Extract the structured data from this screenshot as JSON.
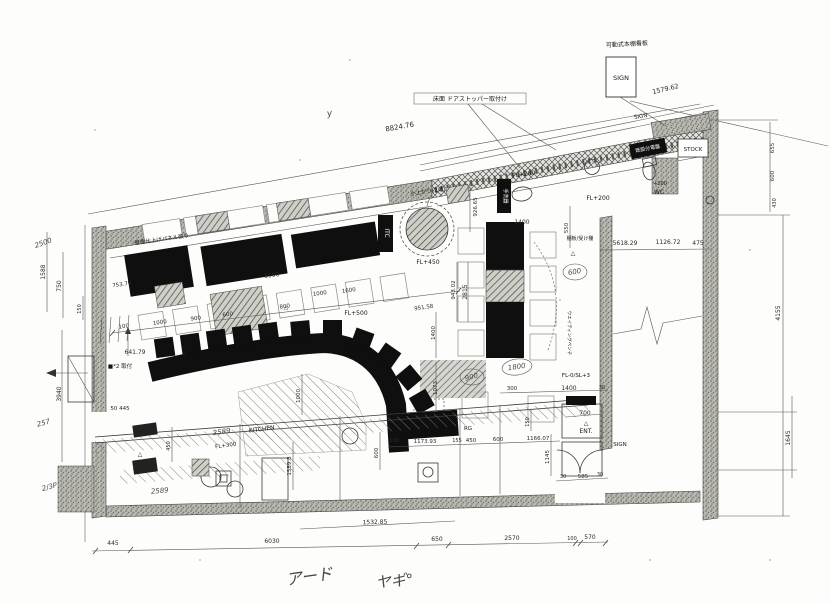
{
  "document": {
    "kind": "scanned architectural floor plan",
    "rooms": [
      "KITCHEN",
      "STOCK",
      "WC",
      "ENT."
    ],
    "floor_levels": [
      "FL+200",
      "FL+200",
      "FL+300",
      "FL+450",
      "FL+500",
      "FL-0/SL+3",
      "+200"
    ],
    "signs": [
      "SIGN",
      "SIGN",
      "SIGN",
      "SIGN"
    ],
    "colors": {
      "paper": "#fdfdfb",
      "ink": "#1f1f1f",
      "wall_gray": "#b9b9b2",
      "fill_black": "#0f0f0f"
    }
  },
  "annotations": [
    {
      "t": "可動式本棚看板",
      "x": 627,
      "y": 46,
      "r": -3,
      "s": 6,
      "c": "l"
    },
    {
      "t": "SIGN",
      "x": 621,
      "y": 80,
      "r": 0,
      "s": 6.5,
      "c": "l"
    },
    {
      "t": "1579.62",
      "x": 666,
      "y": 91,
      "r": -13,
      "s": 6.5,
      "c": "d"
    },
    {
      "t": "SIGN",
      "x": 641,
      "y": 118,
      "r": -10,
      "s": 5.5,
      "c": "l"
    },
    {
      "t": "8824.76",
      "x": 400,
      "y": 129,
      "r": -10,
      "s": 7,
      "c": "d"
    },
    {
      "t": "床面 ドアストッパー取付け",
      "x": 470,
      "y": 101,
      "r": 0,
      "s": 6,
      "c": "l"
    },
    {
      "t": "y",
      "x": 330,
      "y": 116,
      "r": -10,
      "s": 9,
      "c": "h"
    },
    {
      "t": "STOCK",
      "x": 693,
      "y": 151,
      "r": 0,
      "s": 5.5,
      "c": "l"
    },
    {
      "t": "既設分電盤",
      "x": 648,
      "y": 150,
      "r": -11,
      "s": 5,
      "c": "w"
    },
    {
      "t": "FL+200",
      "x": 524,
      "y": 176,
      "r": -8,
      "s": 6,
      "c": "l"
    },
    {
      "t": "FL+200",
      "x": 598,
      "y": 200,
      "r": 0,
      "s": 6,
      "c": "l"
    },
    {
      "t": "+200",
      "x": 660,
      "y": 185,
      "r": 0,
      "s": 5,
      "c": "l"
    },
    {
      "t": "WC",
      "x": 659,
      "y": 194,
      "r": 0,
      "s": 6,
      "c": "l"
    },
    {
      "t": "手洗器",
      "x": 504,
      "y": 196,
      "r": 90,
      "s": 5,
      "c": "w"
    },
    {
      "t": "小上がり(2卓)",
      "x": 428,
      "y": 193,
      "r": -8,
      "s": 5.5,
      "c": "l"
    },
    {
      "t": "ITC",
      "x": 385,
      "y": 233,
      "r": 90,
      "s": 6,
      "c": "w"
    },
    {
      "t": "FL+450",
      "x": 428,
      "y": 264,
      "r": 0,
      "s": 6,
      "c": "l"
    },
    {
      "t": "926.65",
      "x": 477,
      "y": 207,
      "r": -90,
      "s": 5.5,
      "c": "d"
    },
    {
      "t": "943.02",
      "x": 455,
      "y": 290,
      "r": -90,
      "s": 5.5,
      "c": "d"
    },
    {
      "t": "2815",
      "x": 467,
      "y": 292,
      "r": -90,
      "s": 6,
      "c": "d"
    },
    {
      "t": "5618.29",
      "x": 625,
      "y": 245,
      "r": 0,
      "s": 6,
      "c": "d"
    },
    {
      "t": "1126.72",
      "x": 668,
      "y": 244,
      "r": 0,
      "s": 6,
      "c": "d"
    },
    {
      "t": "475",
      "x": 698,
      "y": 245,
      "r": 0,
      "s": 6,
      "c": "d"
    },
    {
      "t": "550",
      "x": 568,
      "y": 228,
      "r": -90,
      "s": 5.5,
      "c": "d"
    },
    {
      "t": "1400",
      "x": 522,
      "y": 224,
      "r": 0,
      "s": 6,
      "c": "d"
    },
    {
      "t": "棚板/受け棚",
      "x": 580,
      "y": 240,
      "r": 0,
      "s": 5,
      "c": "l"
    },
    {
      "t": "△",
      "x": 573,
      "y": 255,
      "r": 0,
      "s": 6,
      "c": "l"
    },
    {
      "t": "壁面仕上げパネル張り",
      "x": 162,
      "y": 241,
      "r": -8,
      "s": 5.5,
      "c": "l"
    },
    {
      "t": "753.79",
      "x": 122,
      "y": 286,
      "r": -8,
      "s": 5.5,
      "c": "d"
    },
    {
      "t": "5500",
      "x": 272,
      "y": 277,
      "r": -8,
      "s": 6,
      "c": "d"
    },
    {
      "t": "100",
      "x": 124,
      "y": 328,
      "r": -8,
      "s": 5.5,
      "c": "d"
    },
    {
      "t": "1000",
      "x": 160,
      "y": 324,
      "r": -8,
      "s": 5.5,
      "c": "d"
    },
    {
      "t": "900",
      "x": 196,
      "y": 320,
      "r": -8,
      "s": 5.5,
      "c": "d"
    },
    {
      "t": "600",
      "x": 228,
      "y": 316,
      "r": -8,
      "s": 5.5,
      "c": "d"
    },
    {
      "t": "800",
      "x": 285,
      "y": 308,
      "r": -8,
      "s": 5.5,
      "c": "d"
    },
    {
      "t": "1000",
      "x": 320,
      "y": 295,
      "r": -8,
      "s": 5.5,
      "c": "d"
    },
    {
      "t": "1600",
      "x": 349,
      "y": 292,
      "r": -8,
      "s": 5.5,
      "c": "d"
    },
    {
      "t": "△",
      "x": 286,
      "y": 309,
      "r": 0,
      "s": 5.5,
      "c": "l"
    },
    {
      "t": "FL+500",
      "x": 356,
      "y": 315,
      "r": 0,
      "s": 6,
      "c": "l"
    },
    {
      "t": "951.58",
      "x": 424,
      "y": 309,
      "r": -8,
      "s": 5.5,
      "c": "d"
    },
    {
      "t": "1400",
      "x": 435,
      "y": 333,
      "r": -90,
      "s": 5.5,
      "c": "d"
    },
    {
      "t": "1073",
      "x": 437,
      "y": 388,
      "r": -90,
      "s": 5.5,
      "c": "d"
    },
    {
      "t": "1000",
      "x": 300,
      "y": 396,
      "r": -90,
      "s": 5.5,
      "c": "d"
    },
    {
      "t": "641.79",
      "x": 135,
      "y": 354,
      "r": 0,
      "s": 6,
      "c": "d"
    },
    {
      "t": "■*2 取付",
      "x": 120,
      "y": 368,
      "r": 0,
      "s": 5.5,
      "c": "l"
    },
    {
      "t": "3940",
      "x": 61,
      "y": 394,
      "r": -90,
      "s": 6,
      "c": "d"
    },
    {
      "t": "1588",
      "x": 45,
      "y": 272,
      "r": -90,
      "s": 6,
      "c": "d"
    },
    {
      "t": "750",
      "x": 61,
      "y": 286,
      "r": -90,
      "s": 6,
      "c": "d"
    },
    {
      "t": "150",
      "x": 81,
      "y": 309,
      "r": -90,
      "s": 5,
      "c": "d"
    },
    {
      "t": "2500",
      "x": 44,
      "y": 245,
      "r": -20,
      "s": 7,
      "c": "h"
    },
    {
      "t": "257",
      "x": 44,
      "y": 425,
      "r": -15,
      "s": 7,
      "c": "h"
    },
    {
      "t": "2/3P",
      "x": 50,
      "y": 489,
      "r": -15,
      "s": 7,
      "c": "h"
    },
    {
      "t": "50 445",
      "x": 120,
      "y": 410,
      "r": 0,
      "s": 5.5,
      "c": "d"
    },
    {
      "t": "△",
      "x": 140,
      "y": 456,
      "r": 0,
      "s": 6,
      "c": "l"
    },
    {
      "t": "KITCHEN",
      "x": 262,
      "y": 431,
      "r": -8,
      "s": 6,
      "c": "l"
    },
    {
      "t": "FL+300",
      "x": 226,
      "y": 447,
      "r": -8,
      "s": 5.5,
      "c": "l"
    },
    {
      "t": "2589",
      "x": 222,
      "y": 434,
      "r": -8,
      "s": 7,
      "c": "h"
    },
    {
      "t": "2589",
      "x": 160,
      "y": 493,
      "r": -5,
      "s": 7,
      "c": "h"
    },
    {
      "t": "450",
      "x": 170,
      "y": 446,
      "r": -90,
      "s": 5,
      "c": "d"
    },
    {
      "t": "1559.8",
      "x": 291,
      "y": 466,
      "r": -90,
      "s": 5.5,
      "c": "d"
    },
    {
      "t": "600",
      "x": 378,
      "y": 453,
      "r": -90,
      "s": 5.5,
      "c": "d"
    },
    {
      "t": "100",
      "x": 394,
      "y": 442,
      "r": 0,
      "s": 5,
      "c": "d"
    },
    {
      "t": "1173.93",
      "x": 425,
      "y": 443,
      "r": 0,
      "s": 5.5,
      "c": "d"
    },
    {
      "t": "155",
      "x": 457,
      "y": 442,
      "r": 0,
      "s": 5,
      "c": "d"
    },
    {
      "t": "450",
      "x": 471,
      "y": 442,
      "r": 0,
      "s": 5.5,
      "c": "d"
    },
    {
      "t": "600",
      "x": 498,
      "y": 441,
      "r": 0,
      "s": 5.5,
      "c": "d"
    },
    {
      "t": "1166.07",
      "x": 538,
      "y": 440,
      "r": 0,
      "s": 5.5,
      "c": "d"
    },
    {
      "t": "RG",
      "x": 468,
      "y": 430,
      "r": 0,
      "s": 5.5,
      "c": "l"
    },
    {
      "t": "150",
      "x": 529,
      "y": 422,
      "r": -90,
      "s": 5,
      "c": "d"
    },
    {
      "t": "1145",
      "x": 549,
      "y": 457,
      "r": -90,
      "s": 5.5,
      "c": "d"
    },
    {
      "t": "700",
      "x": 585,
      "y": 415,
      "r": 0,
      "s": 6,
      "c": "d"
    },
    {
      "t": "△",
      "x": 586,
      "y": 425,
      "r": 0,
      "s": 6,
      "c": "l"
    },
    {
      "t": "ENT.",
      "x": 586,
      "y": 433,
      "r": 0,
      "s": 6,
      "c": "l"
    },
    {
      "t": "585",
      "x": 583,
      "y": 478,
      "r": 0,
      "s": 5.5,
      "c": "d"
    },
    {
      "t": "30",
      "x": 563,
      "y": 478,
      "r": 0,
      "s": 5,
      "c": "d"
    },
    {
      "t": "30",
      "x": 600,
      "y": 476,
      "r": 0,
      "s": 5,
      "c": "d"
    },
    {
      "t": "SIGN",
      "x": 620,
      "y": 446,
      "r": 0,
      "s": 5.5,
      "c": "l"
    },
    {
      "t": "FL-0/SL+3",
      "x": 576,
      "y": 377,
      "r": 0,
      "s": 5.5,
      "c": "l"
    },
    {
      "t": "300",
      "x": 512,
      "y": 390,
      "r": 0,
      "s": 5.5,
      "c": "d"
    },
    {
      "t": "1400",
      "x": 569,
      "y": 390,
      "r": 0,
      "s": 6,
      "c": "d"
    },
    {
      "t": "30",
      "x": 602,
      "y": 389,
      "r": 0,
      "s": 5,
      "c": "d"
    },
    {
      "t": "ウエイティングベンチ",
      "x": 568,
      "y": 333,
      "r": 90,
      "s": 4.5,
      "c": "l"
    },
    {
      "t": "1800",
      "x": 517,
      "y": 369,
      "r": -8,
      "s": 7,
      "c": "h"
    },
    {
      "t": "900",
      "x": 472,
      "y": 379,
      "r": -15,
      "s": 7,
      "c": "h"
    },
    {
      "t": "600",
      "x": 575,
      "y": 274,
      "r": -10,
      "s": 7,
      "c": "h"
    },
    {
      "t": "1532.85",
      "x": 375,
      "y": 524,
      "r": -2,
      "s": 6,
      "c": "d"
    },
    {
      "t": "445",
      "x": 113,
      "y": 545,
      "r": 0,
      "s": 6,
      "c": "d"
    },
    {
      "t": "6030",
      "x": 272,
      "y": 543,
      "r": 0,
      "s": 6,
      "c": "d"
    },
    {
      "t": "650",
      "x": 437,
      "y": 541,
      "r": 0,
      "s": 6,
      "c": "d"
    },
    {
      "t": "2570",
      "x": 512,
      "y": 540,
      "r": 0,
      "s": 6,
      "c": "d"
    },
    {
      "t": "100",
      "x": 572,
      "y": 540,
      "r": 0,
      "s": 5,
      "c": "d"
    },
    {
      "t": "570",
      "x": 590,
      "y": 539,
      "r": 0,
      "s": 6,
      "c": "d"
    },
    {
      "t": "4155",
      "x": 780,
      "y": 313,
      "r": -90,
      "s": 6,
      "c": "d"
    },
    {
      "t": "1645",
      "x": 790,
      "y": 438,
      "r": -90,
      "s": 6,
      "c": "d"
    },
    {
      "t": "655",
      "x": 774,
      "y": 148,
      "r": -90,
      "s": 5.5,
      "c": "d"
    },
    {
      "t": "600",
      "x": 774,
      "y": 176,
      "r": -90,
      "s": 5.5,
      "c": "d"
    },
    {
      "t": "430",
      "x": 776,
      "y": 203,
      "r": -90,
      "s": 5,
      "c": "d"
    },
    {
      "t": "アード",
      "x": 310,
      "y": 582,
      "r": -8,
      "s": 16,
      "c": "h"
    },
    {
      "t": "ヤギ°",
      "x": 395,
      "y": 586,
      "r": -5,
      "s": 15,
      "c": "h"
    }
  ]
}
